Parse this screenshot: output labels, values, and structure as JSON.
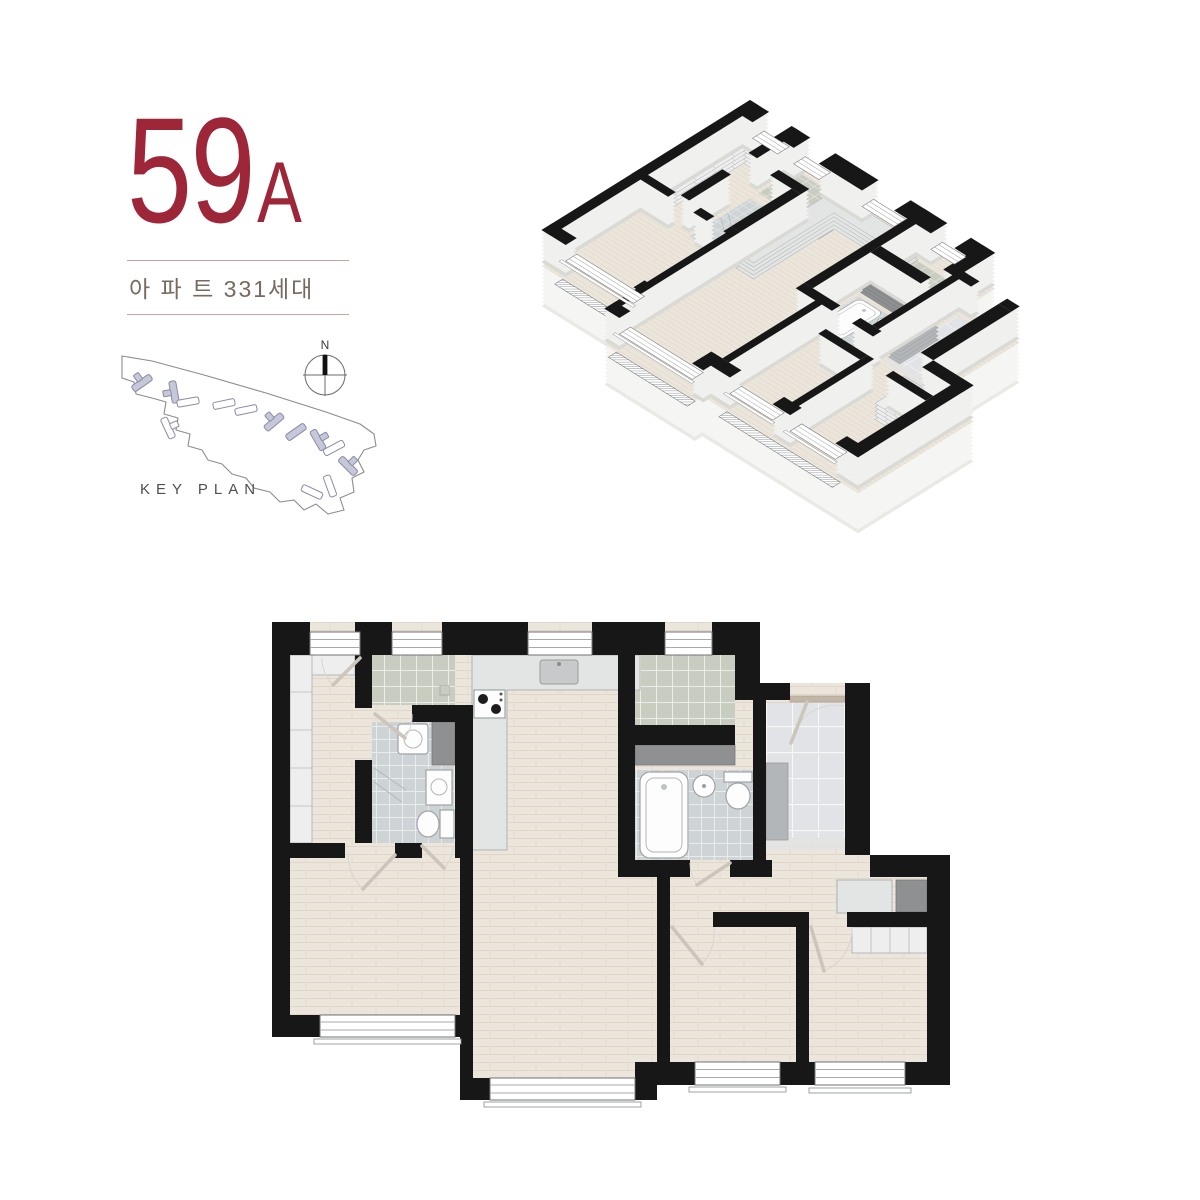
{
  "unit": {
    "number": "59",
    "letter": "A",
    "subtitle": "아 파 트 331세대"
  },
  "key_plan": {
    "label": "KEY PLAN",
    "compass_north": "N"
  },
  "floor_plan": {
    "views": [
      "isometric-3d",
      "top-down-2d"
    ]
  },
  "colors": {
    "accent": "#9e2639",
    "divider": "#c8a4a4",
    "subtitle-text": "#7a695e",
    "keyplan-text": "#4f4f4f",
    "wall": "#171717",
    "wood": "#ebe5db",
    "wood-line": "#ded5c6",
    "tile-green": "#c8ccc1",
    "tile-gray": "#ced3d5",
    "entry-tile": "#e2e3e6",
    "counter": "#e3e4e4",
    "closet": "#eeeeef",
    "cabinet-gray": "#b3b6b8",
    "shaft-dark": "#8e9092",
    "site-line": "#8c8c8c",
    "building-fill": "#c7c7da",
    "building-line": "#8a8aa4",
    "door-leaf": "#cbc5bb",
    "iso-side": "#f0f0ee",
    "iso-slab": "#f5f5f3",
    "entry-door": "#b5aa9d"
  }
}
